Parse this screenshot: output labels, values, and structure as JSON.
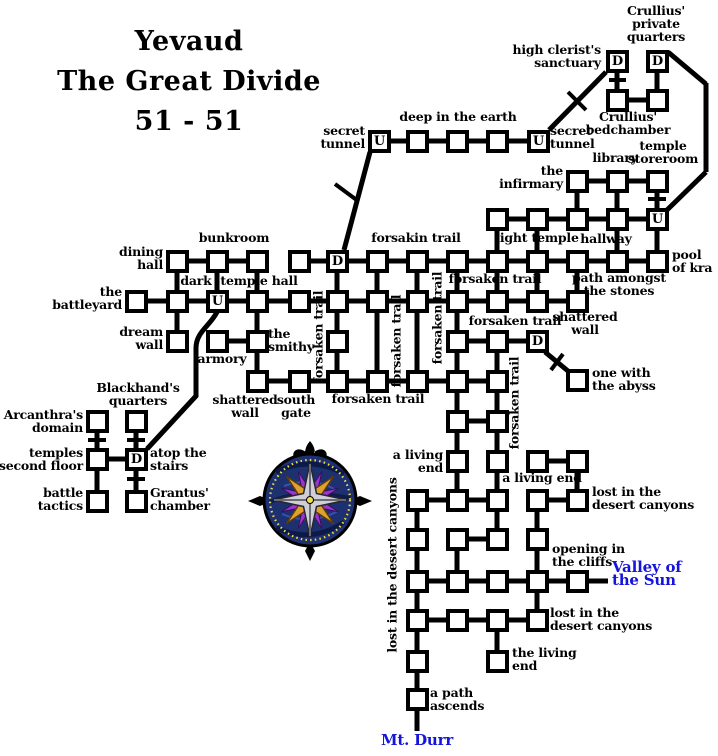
{
  "title": {
    "line1": "Yevaud",
    "line2": "The Great Divide",
    "line3": "51 - 51"
  },
  "colors": {
    "ink": "#000000",
    "background": "#ffffff",
    "exit_text": "#1414dd",
    "compass_blue": "#1d3070",
    "compass_blue_dark": "#0c1840",
    "compass_gold": "#dfa22e",
    "compass_silver": "#cfcfd8",
    "compass_purple": "#9b35d2",
    "compass_dots": "#f0dc4e"
  },
  "legend": {
    "up_letter": "U",
    "down_letter": "D"
  },
  "rooms": [
    {
      "x": 606,
      "y": 50,
      "l": "D",
      "n": "high-clerists-sanctuary"
    },
    {
      "x": 646,
      "y": 50,
      "l": "D",
      "n": "crullius-private-quarters"
    },
    {
      "x": 606,
      "y": 89,
      "n": "crullius-bedchamber-west"
    },
    {
      "x": 646,
      "y": 89,
      "n": "crullius-bedchamber-east"
    },
    {
      "x": 368,
      "y": 130,
      "l": "U",
      "n": "secret-tunnel-west"
    },
    {
      "x": 406,
      "y": 130,
      "n": "deep-in-the-earth-1"
    },
    {
      "x": 446,
      "y": 130,
      "n": "deep-in-the-earth-2"
    },
    {
      "x": 486,
      "y": 130,
      "n": "deep-in-the-earth-3"
    },
    {
      "x": 527,
      "y": 130,
      "l": "U",
      "n": "secret-tunnel-east"
    },
    {
      "x": 566,
      "y": 170,
      "n": "the-infirmary"
    },
    {
      "x": 606,
      "y": 170,
      "n": "library"
    },
    {
      "x": 646,
      "y": 170,
      "n": "temple-storeroom"
    },
    {
      "x": 486,
      "y": 208
    },
    {
      "x": 526,
      "y": 208
    },
    {
      "x": 566,
      "y": 208
    },
    {
      "x": 606,
      "y": 208,
      "n": "hallway"
    },
    {
      "x": 646,
      "y": 208,
      "l": "U",
      "n": "temple-storeroom-stairs"
    },
    {
      "x": 166,
      "y": 250,
      "n": "dining-hall"
    },
    {
      "x": 206,
      "y": 250,
      "n": "bunkroom"
    },
    {
      "x": 246,
      "y": 250
    },
    {
      "x": 288,
      "y": 250
    },
    {
      "x": 326,
      "y": 250,
      "l": "D",
      "n": "forsakin-trail-down"
    },
    {
      "x": 366,
      "y": 250
    },
    {
      "x": 406,
      "y": 250
    },
    {
      "x": 446,
      "y": 250
    },
    {
      "x": 486,
      "y": 250
    },
    {
      "x": 526,
      "y": 250
    },
    {
      "x": 566,
      "y": 250
    },
    {
      "x": 606,
      "y": 250
    },
    {
      "x": 646,
      "y": 250,
      "n": "pool-of-kra"
    },
    {
      "x": 125,
      "y": 290,
      "n": "the-battleyard"
    },
    {
      "x": 166,
      "y": 290
    },
    {
      "x": 206,
      "y": 290,
      "l": "U",
      "n": "dark-temple-hall"
    },
    {
      "x": 246,
      "y": 290
    },
    {
      "x": 288,
      "y": 290
    },
    {
      "x": 326,
      "y": 290
    },
    {
      "x": 366,
      "y": 290
    },
    {
      "x": 406,
      "y": 290
    },
    {
      "x": 446,
      "y": 290
    },
    {
      "x": 486,
      "y": 290
    },
    {
      "x": 526,
      "y": 290
    },
    {
      "x": 566,
      "y": 290,
      "n": "shattered-wall-east"
    },
    {
      "x": 166,
      "y": 330,
      "n": "dream-wall"
    },
    {
      "x": 206,
      "y": 330,
      "n": "armory"
    },
    {
      "x": 246,
      "y": 330,
      "n": "the-smithy"
    },
    {
      "x": 326,
      "y": 330
    },
    {
      "x": 446,
      "y": 330
    },
    {
      "x": 486,
      "y": 330
    },
    {
      "x": 526,
      "y": 330,
      "l": "D",
      "n": "abyss-door"
    },
    {
      "x": 246,
      "y": 370,
      "n": "shattered-wall"
    },
    {
      "x": 288,
      "y": 370,
      "n": "south-gate"
    },
    {
      "x": 326,
      "y": 370
    },
    {
      "x": 366,
      "y": 370
    },
    {
      "x": 406,
      "y": 370
    },
    {
      "x": 446,
      "y": 370
    },
    {
      "x": 486,
      "y": 370
    },
    {
      "x": 566,
      "y": 369,
      "n": "one-with-the-abyss"
    },
    {
      "x": 446,
      "y": 410
    },
    {
      "x": 486,
      "y": 410
    },
    {
      "x": 86,
      "y": 410,
      "n": "arcanthras-domain"
    },
    {
      "x": 125,
      "y": 410,
      "n": "blackhands-quarters"
    },
    {
      "x": 86,
      "y": 448,
      "n": "temples-second-floor"
    },
    {
      "x": 125,
      "y": 448,
      "l": "D",
      "n": "atop-the-stairs"
    },
    {
      "x": 86,
      "y": 490,
      "n": "battle-tactics"
    },
    {
      "x": 125,
      "y": 490,
      "n": "grantus-chamber"
    },
    {
      "x": 446,
      "y": 450,
      "n": "a-living-end-west"
    },
    {
      "x": 486,
      "y": 450
    },
    {
      "x": 526,
      "y": 450
    },
    {
      "x": 566,
      "y": 450,
      "n": "a-living-end-east"
    },
    {
      "x": 406,
      "y": 489
    },
    {
      "x": 446,
      "y": 489
    },
    {
      "x": 486,
      "y": 489
    },
    {
      "x": 526,
      "y": 489
    },
    {
      "x": 566,
      "y": 489,
      "n": "lost-in-the-desert-canyons-ne"
    },
    {
      "x": 406,
      "y": 528
    },
    {
      "x": 446,
      "y": 528
    },
    {
      "x": 486,
      "y": 528
    },
    {
      "x": 526,
      "y": 528,
      "n": "opening-in-the-cliffs"
    },
    {
      "x": 406,
      "y": 570
    },
    {
      "x": 446,
      "y": 570
    },
    {
      "x": 486,
      "y": 570
    },
    {
      "x": 526,
      "y": 570
    },
    {
      "x": 566,
      "y": 570,
      "n": "valley-of-the-sun-exit"
    },
    {
      "x": 406,
      "y": 609
    },
    {
      "x": 446,
      "y": 609
    },
    {
      "x": 486,
      "y": 609
    },
    {
      "x": 526,
      "y": 609
    },
    {
      "x": 406,
      "y": 650
    },
    {
      "x": 486,
      "y": 650,
      "n": "the-living-end"
    },
    {
      "x": 406,
      "y": 688,
      "n": "a-path-ascends"
    }
  ],
  "map_lines": [
    [
      628,
      100,
      646,
      100
    ],
    [
      390,
      141,
      406,
      141
    ],
    [
      428,
      141,
      446,
      141
    ],
    [
      468,
      141,
      486,
      141
    ],
    [
      508,
      141,
      527,
      141
    ],
    [
      588,
      181,
      606,
      181
    ],
    [
      628,
      181,
      646,
      181
    ],
    [
      508,
      219,
      526,
      219
    ],
    [
      548,
      219,
      566,
      219
    ],
    [
      588,
      219,
      606,
      219
    ],
    [
      628,
      219,
      646,
      219
    ],
    [
      188,
      261,
      206,
      261
    ],
    [
      228,
      261,
      246,
      261
    ],
    [
      310,
      261,
      326,
      261
    ],
    [
      348,
      261,
      366,
      261
    ],
    [
      388,
      261,
      406,
      261
    ],
    [
      428,
      261,
      446,
      261
    ],
    [
      468,
      261,
      486,
      261
    ],
    [
      508,
      261,
      526,
      261
    ],
    [
      548,
      261,
      566,
      261
    ],
    [
      588,
      261,
      606,
      261
    ],
    [
      628,
      261,
      646,
      261
    ],
    [
      147,
      301,
      166,
      301
    ],
    [
      188,
      301,
      206,
      301
    ],
    [
      228,
      301,
      246,
      301
    ],
    [
      268,
      301,
      288,
      301
    ],
    [
      310,
      301,
      326,
      301
    ],
    [
      348,
      301,
      366,
      301
    ],
    [
      388,
      301,
      406,
      301
    ],
    [
      428,
      301,
      446,
      301
    ],
    [
      468,
      301,
      486,
      301
    ],
    [
      508,
      301,
      526,
      301
    ],
    [
      548,
      301,
      566,
      301
    ],
    [
      228,
      341,
      246,
      341
    ],
    [
      468,
      341,
      486,
      341
    ],
    [
      508,
      341,
      526,
      341
    ],
    [
      268,
      381,
      288,
      381
    ],
    [
      310,
      381,
      326,
      381
    ],
    [
      348,
      381,
      366,
      381
    ],
    [
      388,
      381,
      406,
      381
    ],
    [
      428,
      381,
      446,
      381
    ],
    [
      468,
      381,
      486,
      381
    ],
    [
      468,
      421,
      486,
      421
    ],
    [
      548,
      461,
      566,
      461
    ],
    [
      428,
      500,
      446,
      500
    ],
    [
      468,
      500,
      486,
      500
    ],
    [
      548,
      500,
      566,
      500
    ],
    [
      468,
      539,
      486,
      539
    ],
    [
      428,
      581,
      446,
      581
    ],
    [
      468,
      581,
      486,
      581
    ],
    [
      508,
      581,
      526,
      581
    ],
    [
      548,
      581,
      566,
      581
    ],
    [
      588,
      581,
      608,
      581
    ],
    [
      428,
      620,
      446,
      620
    ],
    [
      468,
      620,
      486,
      620
    ],
    [
      508,
      620,
      526,
      620
    ],
    [
      108,
      459,
      125,
      459
    ],
    [
      617,
      72,
      617,
      89
    ],
    [
      657,
      72,
      657,
      89
    ],
    [
      577,
      192,
      577,
      208
    ],
    [
      617,
      192,
      617,
      208
    ],
    [
      657,
      192,
      657,
      208
    ],
    [
      497,
      230,
      497,
      250
    ],
    [
      537,
      230,
      537,
      250
    ],
    [
      617,
      230,
      617,
      250
    ],
    [
      657,
      230,
      657,
      250
    ],
    [
      177,
      272,
      177,
      290
    ],
    [
      217,
      272,
      217,
      290
    ],
    [
      257,
      272,
      257,
      290
    ],
    [
      337,
      272,
      337,
      290
    ],
    [
      377,
      272,
      377,
      290
    ],
    [
      417,
      272,
      417,
      290
    ],
    [
      457,
      272,
      457,
      290
    ],
    [
      497,
      272,
      497,
      290
    ],
    [
      537,
      272,
      537,
      290
    ],
    [
      577,
      272,
      577,
      290
    ],
    [
      177,
      312,
      177,
      330
    ],
    [
      257,
      312,
      257,
      330
    ],
    [
      337,
      312,
      337,
      330
    ],
    [
      457,
      312,
      457,
      330
    ],
    [
      377,
      312,
      377,
      370
    ],
    [
      417,
      312,
      417,
      370
    ],
    [
      257,
      352,
      257,
      370
    ],
    [
      337,
      352,
      337,
      370
    ],
    [
      457,
      352,
      457,
      370
    ],
    [
      497,
      352,
      497,
      370
    ],
    [
      457,
      392,
      457,
      410
    ],
    [
      497,
      392,
      497,
      410
    ],
    [
      457,
      432,
      457,
      450
    ],
    [
      497,
      432,
      497,
      450
    ],
    [
      457,
      472,
      457,
      489
    ],
    [
      497,
      472,
      497,
      489
    ],
    [
      577,
      472,
      577,
      489
    ],
    [
      417,
      511,
      417,
      528
    ],
    [
      497,
      511,
      497,
      528
    ],
    [
      537,
      511,
      537,
      528
    ],
    [
      417,
      550,
      417,
      570
    ],
    [
      457,
      550,
      457,
      570
    ],
    [
      537,
      550,
      537,
      570
    ],
    [
      417,
      592,
      417,
      609
    ],
    [
      537,
      592,
      537,
      609
    ],
    [
      417,
      631,
      417,
      650
    ],
    [
      497,
      631,
      497,
      650
    ],
    [
      417,
      672,
      417,
      688
    ],
    [
      417,
      710,
      417,
      731
    ],
    [
      97,
      432,
      97,
      448
    ],
    [
      136,
      432,
      136,
      448
    ],
    [
      97,
      470,
      97,
      490
    ],
    [
      136,
      470,
      136,
      490
    ],
    [
      606,
      72,
      549,
      130
    ],
    [
      370,
      152,
      344,
      250
    ],
    [
      545,
      352,
      568,
      371
    ],
    [
      668,
      52,
      706,
      84
    ],
    [
      706,
      83,
      706,
      172
    ],
    [
      706,
      172,
      667,
      210
    ],
    [
      609,
      80,
      626,
      80,
      4
    ],
    [
      648,
      199,
      666,
      199,
      4
    ],
    [
      568,
      92,
      586,
      110,
      4
    ],
    [
      335,
      184,
      358,
      201,
      4
    ],
    [
      551,
      370,
      563,
      354,
      4
    ],
    [
      88,
      440,
      106,
      440,
      4
    ],
    [
      127,
      440,
      145,
      440,
      4
    ],
    [
      127,
      479,
      145,
      479,
      4
    ]
  ],
  "curve_path": "M217,312 C210,326 196,332 196,348 L196,396 L147,449",
  "labels": [
    {
      "text": "secret\ntunnel",
      "x": 365,
      "y": 124,
      "align": "right"
    },
    {
      "text": "deep in the earth",
      "x": 458,
      "y": 110,
      "align": "center"
    },
    {
      "text": "secret\ntunnel",
      "x": 550,
      "y": 124,
      "align": "left"
    },
    {
      "text": "high clerist's\nsanctuary",
      "x": 601,
      "y": 43,
      "align": "right"
    },
    {
      "text": "Crullius'\nprivate\nquarters",
      "x": 656,
      "y": 4,
      "align": "center"
    },
    {
      "text": "Crullius'\nbedchamber",
      "x": 628,
      "y": 110,
      "align": "center"
    },
    {
      "text": "library",
      "x": 615,
      "y": 151,
      "align": "center"
    },
    {
      "text": "temple\nstoreroom",
      "x": 663,
      "y": 139,
      "align": "center"
    },
    {
      "text": "the\ninfirmary",
      "x": 563,
      "y": 164,
      "align": "right"
    },
    {
      "text": "light temple",
      "x": 537,
      "y": 231,
      "align": "center"
    },
    {
      "text": "hallway",
      "x": 606,
      "y": 232,
      "align": "center"
    },
    {
      "text": "pool\nof kra",
      "x": 672,
      "y": 248,
      "align": "left"
    },
    {
      "text": "path amongst\nthe stones",
      "x": 619,
      "y": 271,
      "align": "center"
    },
    {
      "text": "forsakin trail",
      "x": 416,
      "y": 231,
      "align": "center"
    },
    {
      "text": "forsaken trail",
      "x": 495,
      "y": 272,
      "align": "center"
    },
    {
      "text": "forsaken trail",
      "x": 515,
      "y": 314,
      "align": "center"
    },
    {
      "text": "forsaken trail",
      "x": 378,
      "y": 392,
      "align": "center"
    },
    {
      "text": "shattered\nwall",
      "x": 585,
      "y": 310,
      "align": "center"
    },
    {
      "text": "one with\nthe abyss",
      "x": 592,
      "y": 366,
      "align": "left"
    },
    {
      "text": "bunkroom",
      "x": 234,
      "y": 231,
      "align": "center"
    },
    {
      "text": "dining\nhall",
      "x": 163,
      "y": 245,
      "align": "right"
    },
    {
      "text": "dark",
      "x": 196,
      "y": 274,
      "align": "center"
    },
    {
      "text": "temple hall",
      "x": 259,
      "y": 274,
      "align": "center"
    },
    {
      "text": "the\nbattleyard",
      "x": 122,
      "y": 285,
      "align": "right"
    },
    {
      "text": "dream\nwall",
      "x": 163,
      "y": 325,
      "align": "right"
    },
    {
      "text": "armory",
      "x": 222,
      "y": 352,
      "align": "center"
    },
    {
      "text": "the\nsmithy",
      "x": 268,
      "y": 327,
      "align": "left"
    },
    {
      "text": "shattered\nwall",
      "x": 245,
      "y": 393,
      "align": "center"
    },
    {
      "text": "south\ngate",
      "x": 296,
      "y": 393,
      "align": "center"
    },
    {
      "text": "Blackhand's\nquarters",
      "x": 138,
      "y": 381,
      "align": "center"
    },
    {
      "text": "Arcanthra's\ndomain",
      "x": 83,
      "y": 408,
      "align": "right"
    },
    {
      "text": "temples\nsecond floor",
      "x": 83,
      "y": 446,
      "align": "right"
    },
    {
      "text": "battle\ntactics",
      "x": 83,
      "y": 486,
      "align": "right"
    },
    {
      "text": "atop the\nstairs",
      "x": 150,
      "y": 446,
      "align": "left"
    },
    {
      "text": "Grantus'\nchamber",
      "x": 150,
      "y": 486,
      "align": "left"
    },
    {
      "text": "a living\nend",
      "x": 443,
      "y": 448,
      "align": "right"
    },
    {
      "text": "a living end",
      "x": 542,
      "y": 471,
      "align": "center"
    },
    {
      "text": "lost in the\ndesert canyons",
      "x": 592,
      "y": 485,
      "align": "left"
    },
    {
      "text": "opening in\nthe cliffs",
      "x": 552,
      "y": 542,
      "align": "left"
    },
    {
      "text": "Valley of\nthe Sun",
      "x": 612,
      "y": 561,
      "align": "left",
      "color": "blue",
      "size": 15
    },
    {
      "text": "lost in the\ndesert canyons",
      "x": 550,
      "y": 606,
      "align": "left"
    },
    {
      "text": "the living\nend",
      "x": 512,
      "y": 646,
      "align": "left"
    },
    {
      "text": "a path\nascends",
      "x": 430,
      "y": 686,
      "align": "left"
    },
    {
      "text": "Mt. Durr",
      "x": 417,
      "y": 734,
      "align": "center",
      "color": "blue",
      "size": 15
    },
    {
      "text": "forsaken trail",
      "x": 318,
      "y": 337,
      "vertical": true
    },
    {
      "text": "forsaken trail",
      "x": 396,
      "y": 341,
      "vertical": true
    },
    {
      "text": "forsaken trail",
      "x": 437,
      "y": 318,
      "vertical": true
    },
    {
      "text": "forsaken trail",
      "x": 514,
      "y": 403,
      "vertical": true
    },
    {
      "text": "lost in the desert canyons",
      "x": 392,
      "y": 565,
      "vertical": true
    }
  ]
}
